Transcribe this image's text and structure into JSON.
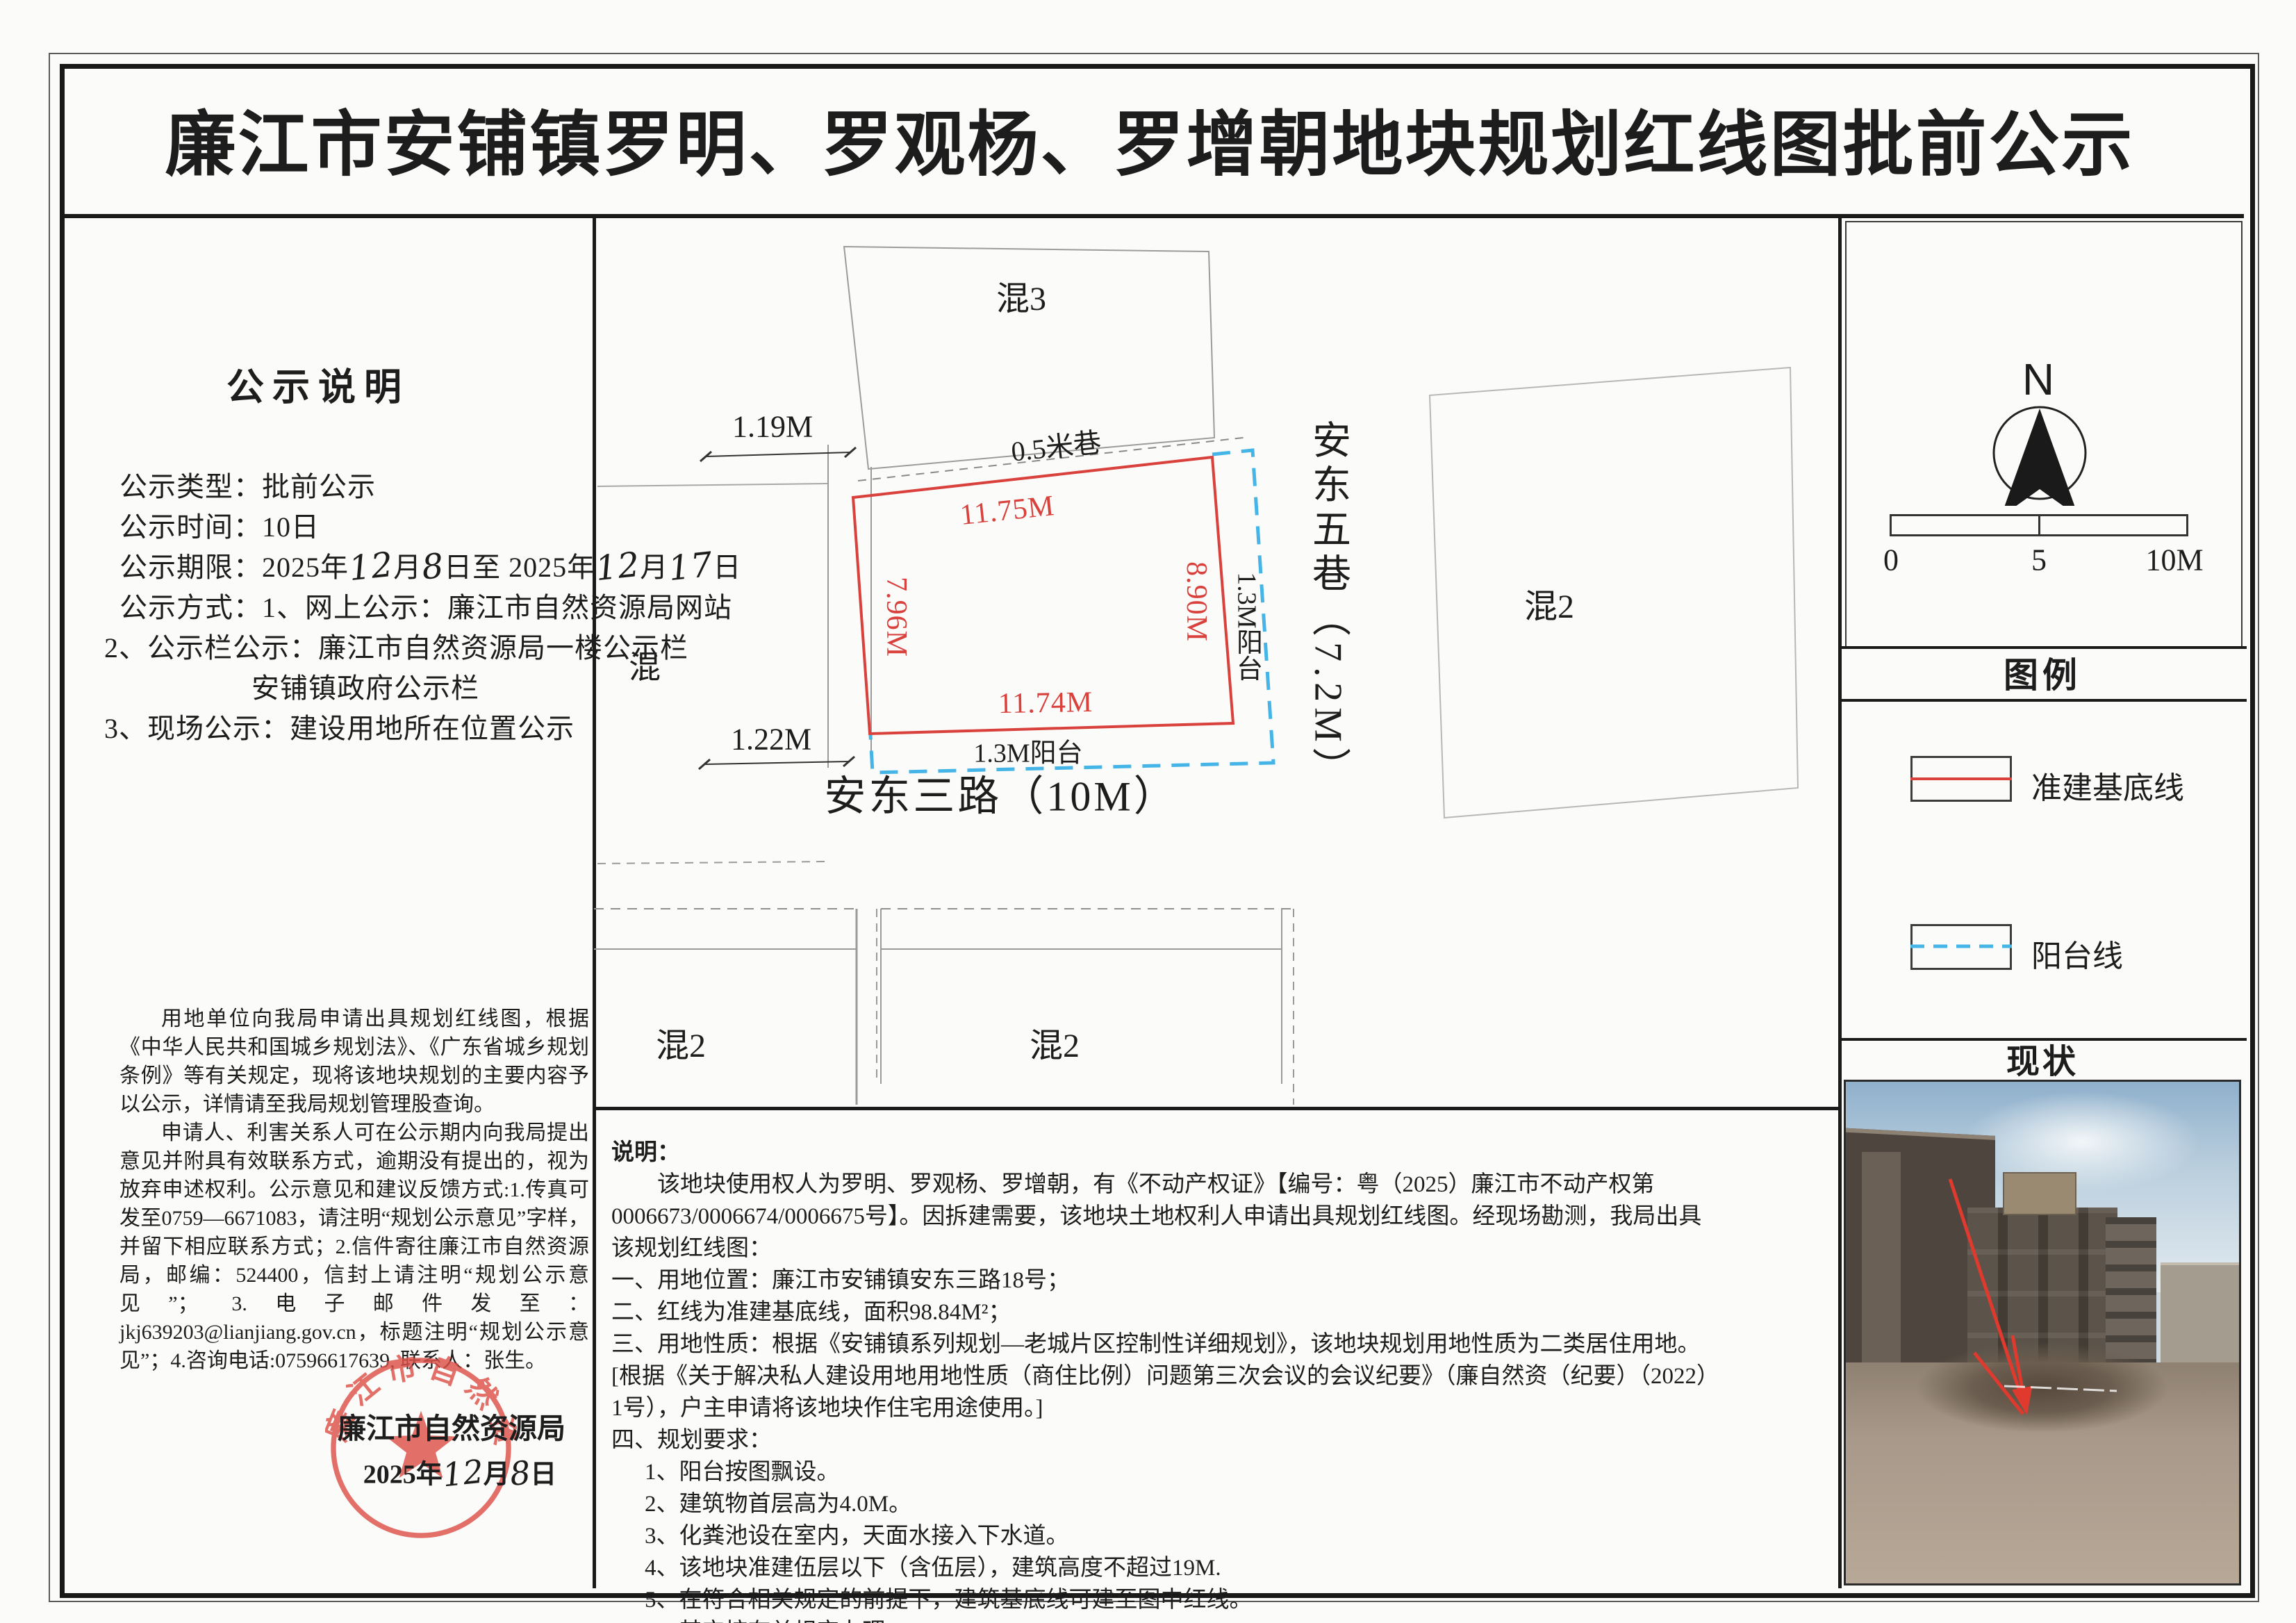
{
  "title": "廉江市安铺镇罗明、罗观杨、罗增朝地块规划红线图批前公示",
  "notice": {
    "heading": "公示说明",
    "type_line": "公示类型：批前公示",
    "time_line": "公示时间：10日",
    "period": {
      "label": "公示期限：",
      "y1": "2025年",
      "m1": "12",
      "mu1": "月",
      "d1": "8",
      "mid": "日至 ",
      "y2": "2025年",
      "m2": "12",
      "mu2": "月",
      "d2": "17",
      "end": "日"
    },
    "method1": "公示方式：1、网上公示：廉江市自然资源局网站",
    "method2": "2、公示栏公示：廉江市自然资源局一楼公示栏",
    "method2b": "安铺镇政府公示栏",
    "method3": "3、现场公示：建设用地所在位置公示",
    "para1": "用地单位向我局申请出具规划红线图，根据《中华人民共和国城乡规划法》、《广东省城乡规划条例》等有关规定，现将该地块规划的主要内容予以公示，详情请至我局规划管理股查询。",
    "para2": "申请人、利害关系人可在公示期内向我局提出意见并附具有效联系方式，逾期没有提出的，视为放弃申述权利。公示意见和建议反馈方式:1.传真可发至0759—6671083，请注明“规划公示意见”字样，并留下相应联系方式；2.信件寄往廉江市自然资源局，邮编：524400，信封上请注明“规划公示意见”； 3.电子邮件发至：jkj639203@lianjiang.gov.cn，标题注明“规划公示意见”；4.咨询电话:07596617639, 联系人：张生。",
    "sign_org": "廉江市自然资源局",
    "sign_date": {
      "y": "2025年",
      "m": "12",
      "mu": "月",
      "d": "8",
      "end": "日"
    },
    "seal_text": "廉江市自然资源局"
  },
  "plan": {
    "hun3": "混3",
    "hun_left": "混",
    "hun2_right": "混2",
    "hun2_bottom_left": "混2",
    "hun2_bottom_mid": "混2",
    "lane": "0.5米巷",
    "dim_top": "11.75M",
    "dim_left": "7.96M",
    "dim_right": "8.90M",
    "dim_bottom": "11.74M",
    "offset_top": "1.19M",
    "offset_bottom": "1.22M",
    "balcony_side": "1.3M阳台",
    "balcony_bottom": "1.3M阳台",
    "road_side": "安东五巷（7.2M）",
    "road_bottom": "安东三路（10M）"
  },
  "notes": {
    "heading": "说明：",
    "intro": "该地块使用权人为罗明、罗观杨、罗增朝，有《不动产权证》【编号：粤（2025）廉江市不动产权第0006673/0006674/0006675号】。因拆建需要，该地块土地权利人申请出具规划红线图。经现场勘测，我局出具该规划红线图：",
    "items": [
      "一、用地位置：廉江市安铺镇安东三路18号；",
      "二、红线为准建基底线，面积98.84M²；",
      "三、用地性质：根据《安铺镇系列规划—老城片区控制性详细规划》，该地块规划用地性质为二类居住用地。[根据《关于解决私人建设用地用地性质（商住比例）问题第三次会议的会议纪要》（廉自然资（纪要）（2022）1号），户主申请将该地块作住宅用途使用。]",
      "四、规划要求：",
      "1、阳台按图飘设。",
      "2、建筑物首层高为4.0M。",
      "3、化粪池设在室内，天面水接入下水道。",
      "4、该地块准建伍层以下（含伍层），建筑高度不超过19M.",
      "5、在符合相关规定的前提下，建筑基底线可建至图中红线。",
      "6、其它按有关规定办理。"
    ]
  },
  "panel": {
    "north": "N",
    "scale0": "0",
    "scale5": "5",
    "scale10": "10M",
    "legend_title": "图例",
    "legend_item1": "准建基底线",
    "legend_item2": "阳台线",
    "status_title": "现状"
  },
  "colors": {
    "redline": "#d9413d",
    "balcony": "#45b4e6",
    "seal": "#dd5149"
  }
}
